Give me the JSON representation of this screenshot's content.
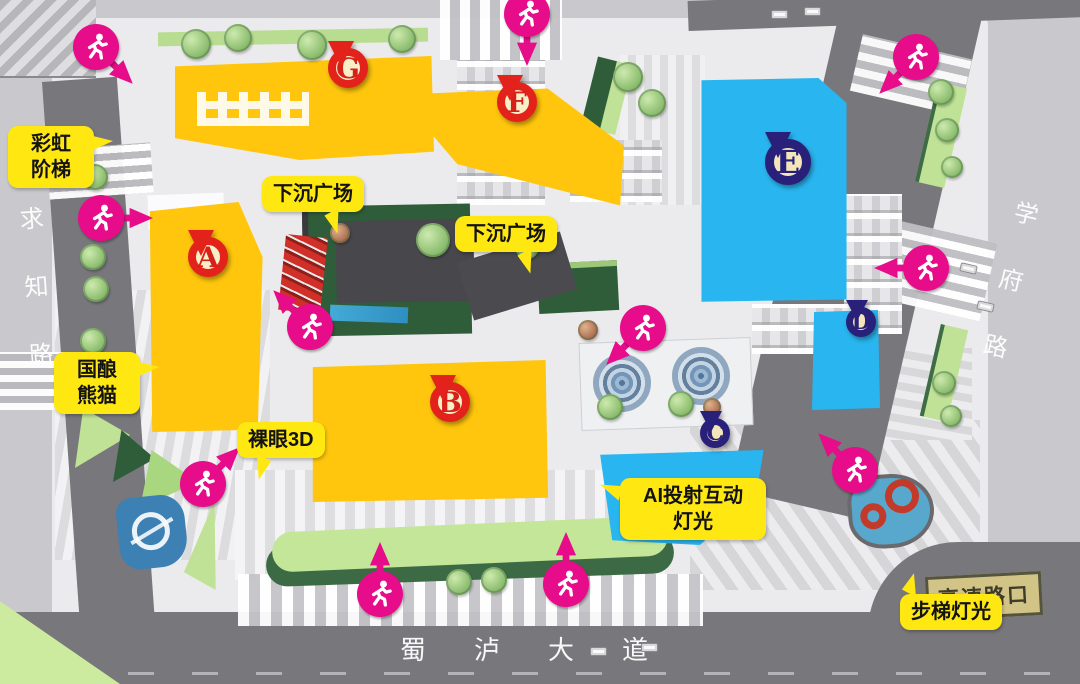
{
  "roads": {
    "left": "求知路",
    "right": "学府路",
    "bottom": "蜀泸大道"
  },
  "corner_sign": "高速路口",
  "pins": [
    {
      "letter": "G",
      "color": "red"
    },
    {
      "letter": "F",
      "color": "red"
    },
    {
      "letter": "A",
      "color": "red"
    },
    {
      "letter": "B",
      "color": "red"
    },
    {
      "letter": "E",
      "color": "navy"
    },
    {
      "letter": "D",
      "color": "navy"
    },
    {
      "letter": "C",
      "color": "navy"
    }
  ],
  "labels": [
    {
      "id": "rainbow-stairs",
      "text": "彩虹\n阶梯"
    },
    {
      "id": "guoniang-panda",
      "text": "国酿\n熊猫"
    },
    {
      "id": "sunken-plaza-1",
      "text": "下沉广场"
    },
    {
      "id": "sunken-plaza-2",
      "text": "下沉广场"
    },
    {
      "id": "naked-eye-3d",
      "text": "裸眼3D"
    },
    {
      "id": "ai-projection-light",
      "text": "AI投射互动\n灯光"
    },
    {
      "id": "stair-light",
      "text": "步梯灯光"
    }
  ],
  "icons": {
    "entrance": "running-person-icon"
  },
  "colors": {
    "building_yellow": "#ffc60d",
    "building_blue": "#29b5ef",
    "pin_red": "#e3221b",
    "pin_navy": "#292079",
    "entrance_pink": "#e60c8a",
    "bubble_yellow": "#ffe812",
    "road_gray": "#77777c"
  }
}
